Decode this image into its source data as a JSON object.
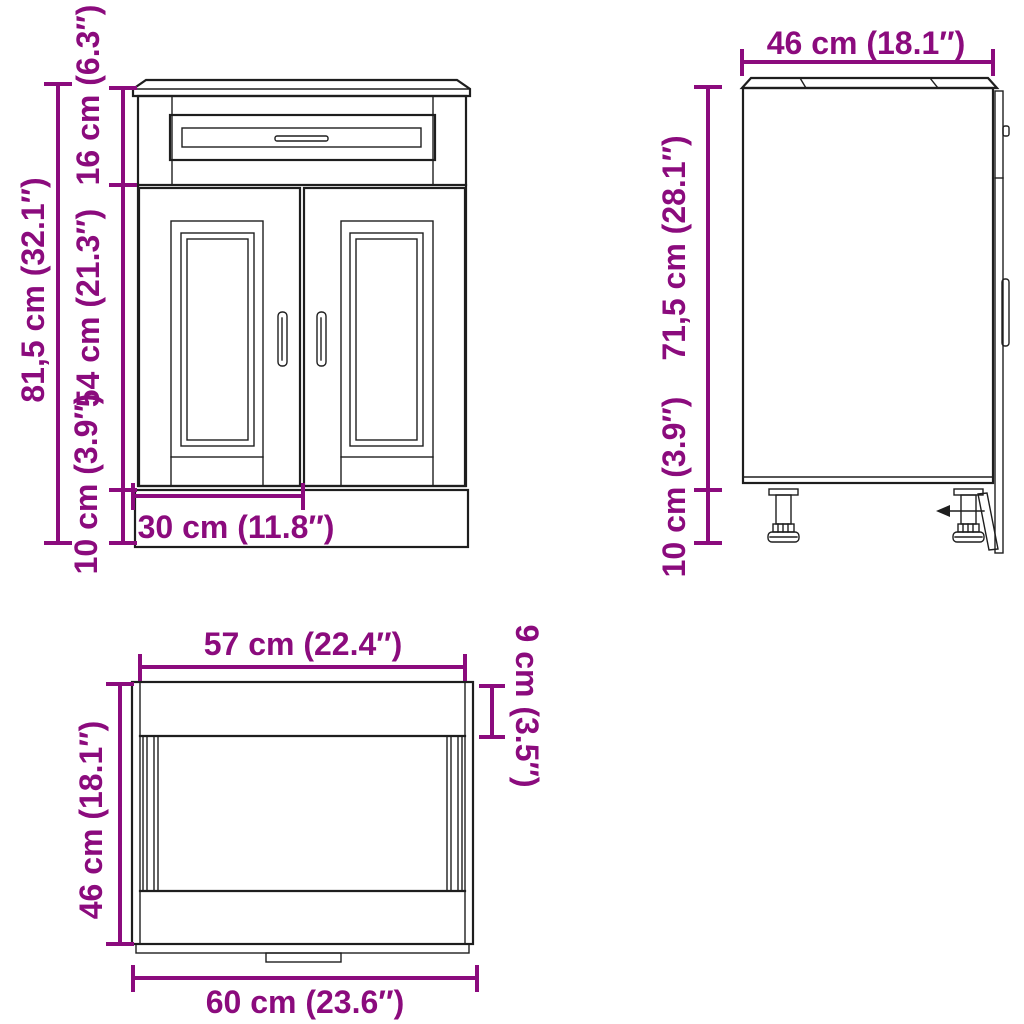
{
  "colors": {
    "background": "#ffffff",
    "line": "#1e1e1e",
    "dimension": "#8B0B7D"
  },
  "front_view": {
    "total_height": "81,5 cm (32.1″)",
    "drawer_height": "16 cm (6.3″)",
    "door_height": "54 cm (21.3″)",
    "base_height": "10 cm (3.9″)",
    "door_width": "30 cm (11.8″)"
  },
  "side_view": {
    "depth": "46 cm (18.1″)",
    "body_height": "71,5 cm (28.1″)",
    "base_height": "10 cm (3.9″)"
  },
  "top_view": {
    "inner_width": "57 cm (22.4″)",
    "back_rail_depth": "9 cm (3.5″)",
    "depth": "46 cm (18.1″)",
    "total_width": "60 cm (23.6″)"
  }
}
